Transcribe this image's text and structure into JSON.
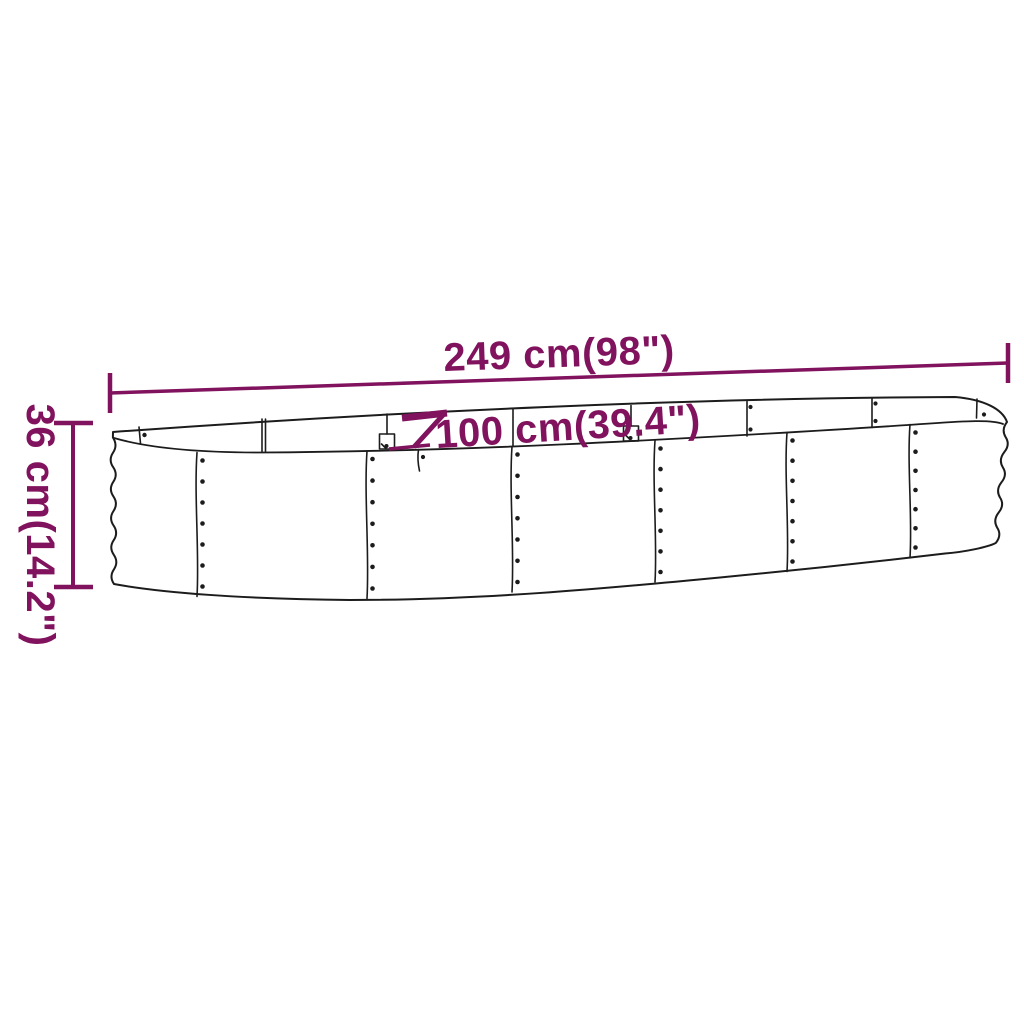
{
  "diagram": {
    "type": "product-dimension-diagram",
    "subject": "oval raised garden bed (powder-coated steel planter)",
    "labels": {
      "length": "249 cm(98\")",
      "width": "100 cm(39.4\")",
      "height": "36 cm(14.2\")"
    }
  },
  "colors": {
    "dimension_accent": "#80125e",
    "line_art": "#1c1c1c",
    "background": "#ffffff"
  }
}
